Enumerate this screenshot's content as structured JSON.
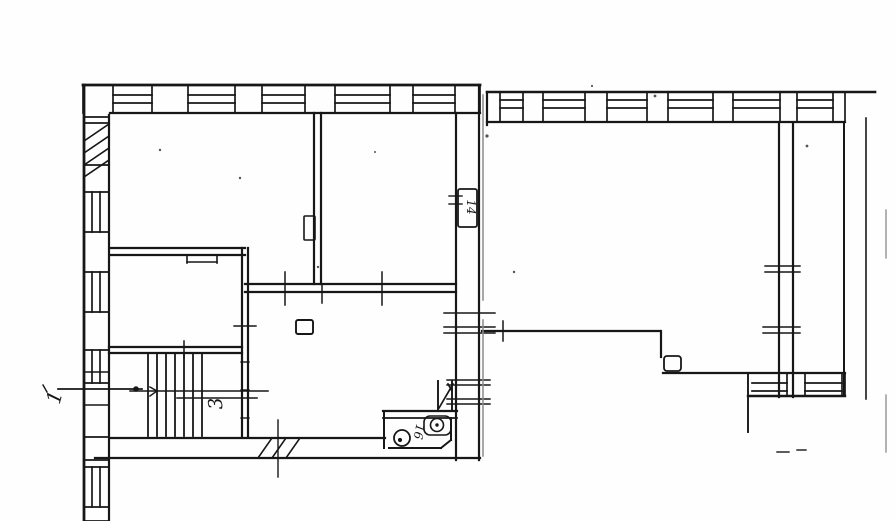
{
  "document": {
    "kind": "scanned-floor-plan",
    "paper_color": "#fefefe",
    "ink_color": "#171717",
    "faint_color": "#8a8a8a"
  },
  "plan": {
    "width": 895,
    "height": 521,
    "room_labels": [
      {
        "id": "entrance-label",
        "text": "1",
        "x": 61,
        "y": 399,
        "rot": -75,
        "size": 20
      },
      {
        "id": "stair-label",
        "text": "3",
        "x": 222,
        "y": 403,
        "rot": -95,
        "size": 19
      },
      {
        "id": "bath-label",
        "text": "16",
        "x": 415,
        "y": 431,
        "rot": 100,
        "size": 12
      },
      {
        "id": "wall-box-label",
        "text": "14",
        "x": 467,
        "y": 207,
        "rot": 90,
        "size": 12
      }
    ],
    "hwalls": [
      {
        "name": "left-wing-top-window-wall",
        "outer": {
          "y": 85,
          "x1": 83,
          "x2": 480,
          "w": 2.8
        },
        "inner": {
          "y": 113,
          "x1": 110,
          "x2": 480,
          "w": 2.2
        },
        "glaze": [
          95,
          103
        ],
        "windows": [
          [
            113,
            152
          ],
          [
            188,
            235
          ],
          [
            262,
            305
          ],
          [
            335,
            390
          ],
          [
            413,
            455
          ]
        ],
        "piers": [
          [
            83,
            113
          ],
          [
            152,
            188
          ],
          [
            235,
            262
          ],
          [
            305,
            335
          ],
          [
            390,
            413
          ],
          [
            455,
            480
          ]
        ]
      },
      {
        "name": "right-wing-top-window-wall",
        "outer": {
          "y": 92,
          "x1": 487,
          "x2": 875,
          "w": 2.6
        },
        "inner": {
          "y": 122,
          "x1": 487,
          "x2": 845,
          "w": 2.2
        },
        "glaze": [
          100,
          108
        ],
        "windows": [
          [
            500,
            523
          ],
          [
            543,
            585
          ],
          [
            607,
            647
          ],
          [
            668,
            713
          ],
          [
            733,
            780
          ],
          [
            797,
            833
          ]
        ],
        "piers": [
          [
            487,
            500
          ],
          [
            523,
            543
          ],
          [
            585,
            607
          ],
          [
            647,
            668
          ],
          [
            713,
            733
          ],
          [
            780,
            797
          ],
          [
            833,
            845
          ]
        ]
      },
      {
        "name": "right-wing-bottom-window-wall",
        "outer": {
          "y": 396,
          "x1": 748,
          "x2": 845,
          "w": 2.4
        },
        "inner": {
          "y": 373,
          "x1": 663,
          "x2": 845,
          "w": 2.2
        },
        "glaze": [
          383,
          391
        ],
        "windows": [
          [
            752,
            787
          ],
          [
            805,
            842
          ]
        ],
        "piers": [
          [
            787,
            805
          ],
          [
            842,
            845
          ]
        ]
      }
    ],
    "vwalls": [
      {
        "name": "left-exterior-window-wall",
        "outer": {
          "x": 84,
          "y1": 85,
          "y2": 521,
          "w": 2.8
        },
        "inner": {
          "x": 109,
          "y1": 115,
          "y2": 521,
          "w": 2.2
        },
        "glaze": [
          92,
          100
        ],
        "windows": [
          [
            192,
            232
          ],
          [
            272,
            312
          ],
          [
            350,
            383
          ],
          [
            467,
            507
          ]
        ],
        "piers": [
          [
            117,
            123
          ],
          [
            165,
            192
          ],
          [
            232,
            272
          ],
          [
            312,
            350
          ],
          [
            383,
            437
          ],
          [
            460,
            467
          ],
          [
            507,
            521
          ]
        ]
      }
    ],
    "hatches": [
      {
        "name": "party-wall-hatch",
        "lines": [
          [
            84,
            141,
            109,
            124
          ],
          [
            84,
            153,
            109,
            136
          ],
          [
            84,
            165,
            109,
            148
          ],
          [
            84,
            177,
            109,
            160
          ]
        ]
      },
      {
        "name": "bottom-door-hatch",
        "lines": [
          [
            258,
            458,
            272,
            438
          ],
          [
            272,
            458,
            286,
            438
          ],
          [
            286,
            458,
            300,
            438
          ]
        ]
      }
    ],
    "stairs": {
      "name": "staircase-treads",
      "x1": 148,
      "x2": 202,
      "y1": 353,
      "y2": 436,
      "count": 7
    },
    "walls_double": [
      {
        "name": "room-divider-top",
        "lines": [
          [
            110,
            248,
            245,
            248
          ],
          [
            110,
            255,
            245,
            255
          ]
        ]
      },
      {
        "name": "room-divider-vertical",
        "lines": [
          [
            314,
            113,
            314,
            284
          ],
          [
            321,
            113,
            321,
            284
          ]
        ]
      },
      {
        "name": "hall-top-wall",
        "lines": [
          [
            245,
            284,
            456,
            284
          ],
          [
            245,
            292,
            456,
            292
          ]
        ]
      },
      {
        "name": "stair-hall-wall",
        "lines": [
          [
            242,
            248,
            242,
            437
          ],
          [
            248,
            248,
            248,
            437
          ]
        ]
      },
      {
        "name": "stair-room-top-wall",
        "lines": [
          [
            109,
            347,
            242,
            347
          ],
          [
            109,
            353,
            242,
            353
          ]
        ]
      },
      {
        "name": "left-wing-right-wall",
        "lines": [
          [
            456,
            113,
            456,
            460
          ],
          [
            479,
            85,
            479,
            460
          ]
        ]
      },
      {
        "name": "left-wing-bottom-wall",
        "lines": [
          [
            110,
            438,
            385,
            438
          ],
          [
            95,
            458,
            480,
            458
          ]
        ]
      },
      {
        "name": "right-wing-inner-wall",
        "lines": [
          [
            779,
            123,
            779,
            397
          ],
          [
            793,
            123,
            793,
            397
          ]
        ]
      }
    ],
    "lines": [
      [
        187,
        255,
        187,
        263,
        1.6
      ],
      [
        217,
        255,
        217,
        263,
        1.6
      ],
      [
        187,
        262,
        217,
        262,
        1.6
      ],
      [
        482,
        331,
        660,
        331,
        2.2
      ],
      [
        661,
        331,
        661,
        357,
        2.2
      ],
      [
        844,
        123,
        844,
        394,
        2.0
      ],
      [
        866,
        118,
        866,
        399,
        1.6
      ],
      [
        748,
        373,
        748,
        432,
        1.9
      ],
      [
        777,
        452,
        789,
        452,
        1.4
      ],
      [
        797,
        450,
        806,
        450,
        1.4
      ],
      [
        503,
        321,
        503,
        341,
        1.5
      ],
      [
        444,
        313,
        495,
        313,
        1.4
      ],
      [
        444,
        327,
        495,
        327,
        1.4
      ],
      [
        444,
        333,
        495,
        333,
        1.4
      ],
      [
        447,
        380,
        490,
        380,
        1.4
      ],
      [
        447,
        385,
        490,
        385,
        1.4
      ],
      [
        447,
        399,
        490,
        399,
        1.4
      ],
      [
        447,
        404,
        490,
        404,
        1.4
      ],
      [
        765,
        266,
        800,
        266,
        1.4
      ],
      [
        765,
        272,
        800,
        272,
        1.4
      ],
      [
        763,
        327,
        800,
        327,
        1.4
      ],
      [
        763,
        333,
        800,
        333,
        1.4
      ],
      [
        285,
        272,
        285,
        305,
        1.5
      ],
      [
        382,
        272,
        382,
        305,
        1.5
      ],
      [
        322,
        284,
        322,
        303,
        1.5
      ],
      [
        234,
        326,
        256,
        326,
        1.4
      ],
      [
        241,
        362,
        249,
        362,
        1.4
      ],
      [
        241,
        390,
        249,
        390,
        1.4
      ],
      [
        241,
        418,
        249,
        418,
        1.4
      ],
      [
        184,
        341,
        184,
        357,
        1.5
      ],
      [
        84,
        372,
        109,
        372,
        1.5
      ],
      [
        84,
        405,
        109,
        405,
        1.5
      ],
      [
        58,
        389,
        142,
        389,
        1.7
      ],
      [
        130,
        391,
        268,
        391,
        1.5
      ],
      [
        177,
        398,
        257,
        398,
        1.5
      ],
      [
        150,
        387,
        157,
        391,
        1.5
      ],
      [
        150,
        396,
        157,
        391,
        1.5
      ],
      [
        439,
        408,
        453,
        384,
        1.7
      ],
      [
        448,
        384,
        452,
        391,
        1.7
      ],
      [
        438,
        381,
        438,
        410,
        1.9
      ],
      [
        452,
        381,
        452,
        410,
        1.9
      ],
      [
        383,
        411,
        457,
        411,
        2.2
      ],
      [
        383,
        418,
        457,
        418,
        1.7
      ],
      [
        384,
        411,
        384,
        448,
        2.0
      ],
      [
        389,
        448,
        441,
        448,
        2.0
      ],
      [
        451,
        418,
        451,
        440,
        2.0
      ],
      [
        441,
        448,
        451,
        440,
        2.0
      ],
      [
        449,
        196,
        462,
        196,
        1.4
      ],
      [
        449,
        204,
        462,
        204,
        1.4
      ],
      [
        43,
        385,
        47,
        392,
        1.4
      ],
      [
        487,
        92,
        487,
        125,
        2.2
      ],
      [
        278,
        420,
        278,
        477,
        1.4
      ]
    ],
    "faint_lines": [
      [
        886,
        210,
        886,
        258,
        1.3
      ],
      [
        886,
        395,
        886,
        452,
        1.3
      ],
      [
        483,
        95,
        483,
        300,
        1.5
      ],
      [
        483,
        320,
        483,
        456,
        1.5
      ]
    ],
    "rects": [
      {
        "name": "hall-flue-box",
        "x": 296,
        "y": 320,
        "w": 17,
        "h": 14,
        "sw": 1.9,
        "rx": 2
      },
      {
        "name": "wall-label-box",
        "x": 458,
        "y": 189,
        "w": 19,
        "h": 38,
        "sw": 1.8,
        "rx": 2
      },
      {
        "name": "corner-jog-box",
        "x": 664,
        "y": 356,
        "w": 17,
        "h": 15,
        "sw": 1.8,
        "rx": 3
      },
      {
        "name": "wall-niche-box",
        "x": 304,
        "y": 216,
        "w": 11,
        "h": 24,
        "sw": 1.6,
        "rx": 1
      },
      {
        "name": "bath-cistern-box",
        "x": 424,
        "y": 416,
        "w": 27,
        "h": 19,
        "sw": 1.6,
        "rx": 6
      }
    ],
    "circles": [
      {
        "name": "toilet-bowl",
        "cx": 402,
        "cy": 438,
        "r": 8,
        "sw": 1.8
      },
      {
        "name": "basin-circle",
        "cx": 437,
        "cy": 425,
        "r": 6.5,
        "sw": 1.6
      }
    ],
    "dots": [
      {
        "name": "entrance-arrow-dot",
        "cx": 136,
        "cy": 389,
        "r": 2.8
      },
      {
        "name": "toilet-dot",
        "cx": 400,
        "cy": 440,
        "r": 2.1
      },
      {
        "name": "basin-dot",
        "cx": 437,
        "cy": 425,
        "r": 1.7
      }
    ],
    "specks": [
      [
        655,
        96,
        1.4
      ],
      [
        487,
        136,
        1.6
      ],
      [
        807,
        146,
        1.4
      ],
      [
        240,
        178,
        1.2
      ],
      [
        514,
        272,
        1.2
      ],
      [
        318,
        267,
        1.2
      ],
      [
        160,
        150,
        1.2
      ],
      [
        375,
        152,
        1.0
      ],
      [
        592,
        86,
        1.1
      ]
    ]
  }
}
